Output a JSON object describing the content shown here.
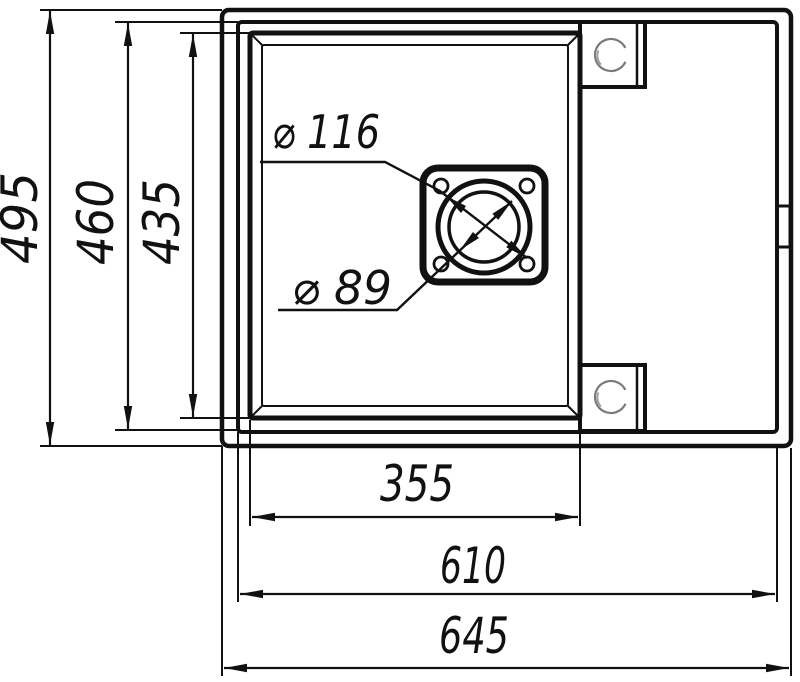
{
  "drawing": {
    "type": "technical-drawing",
    "subject": "kitchen sink top view with drain and mounting dimensions",
    "units": "mm",
    "colors": {
      "line": "#111111",
      "background": "#ffffff",
      "sketch_circle": "#7a7a7a"
    },
    "dimensions": {
      "overall_height": "495",
      "inner_height": "460",
      "bowl_height": "435",
      "bowl_width": "355",
      "inner_width": "610",
      "overall_width": "645",
      "drain_flange_diameter": "⌀ 116",
      "drain_hole_diameter": "⌀ 89"
    }
  }
}
